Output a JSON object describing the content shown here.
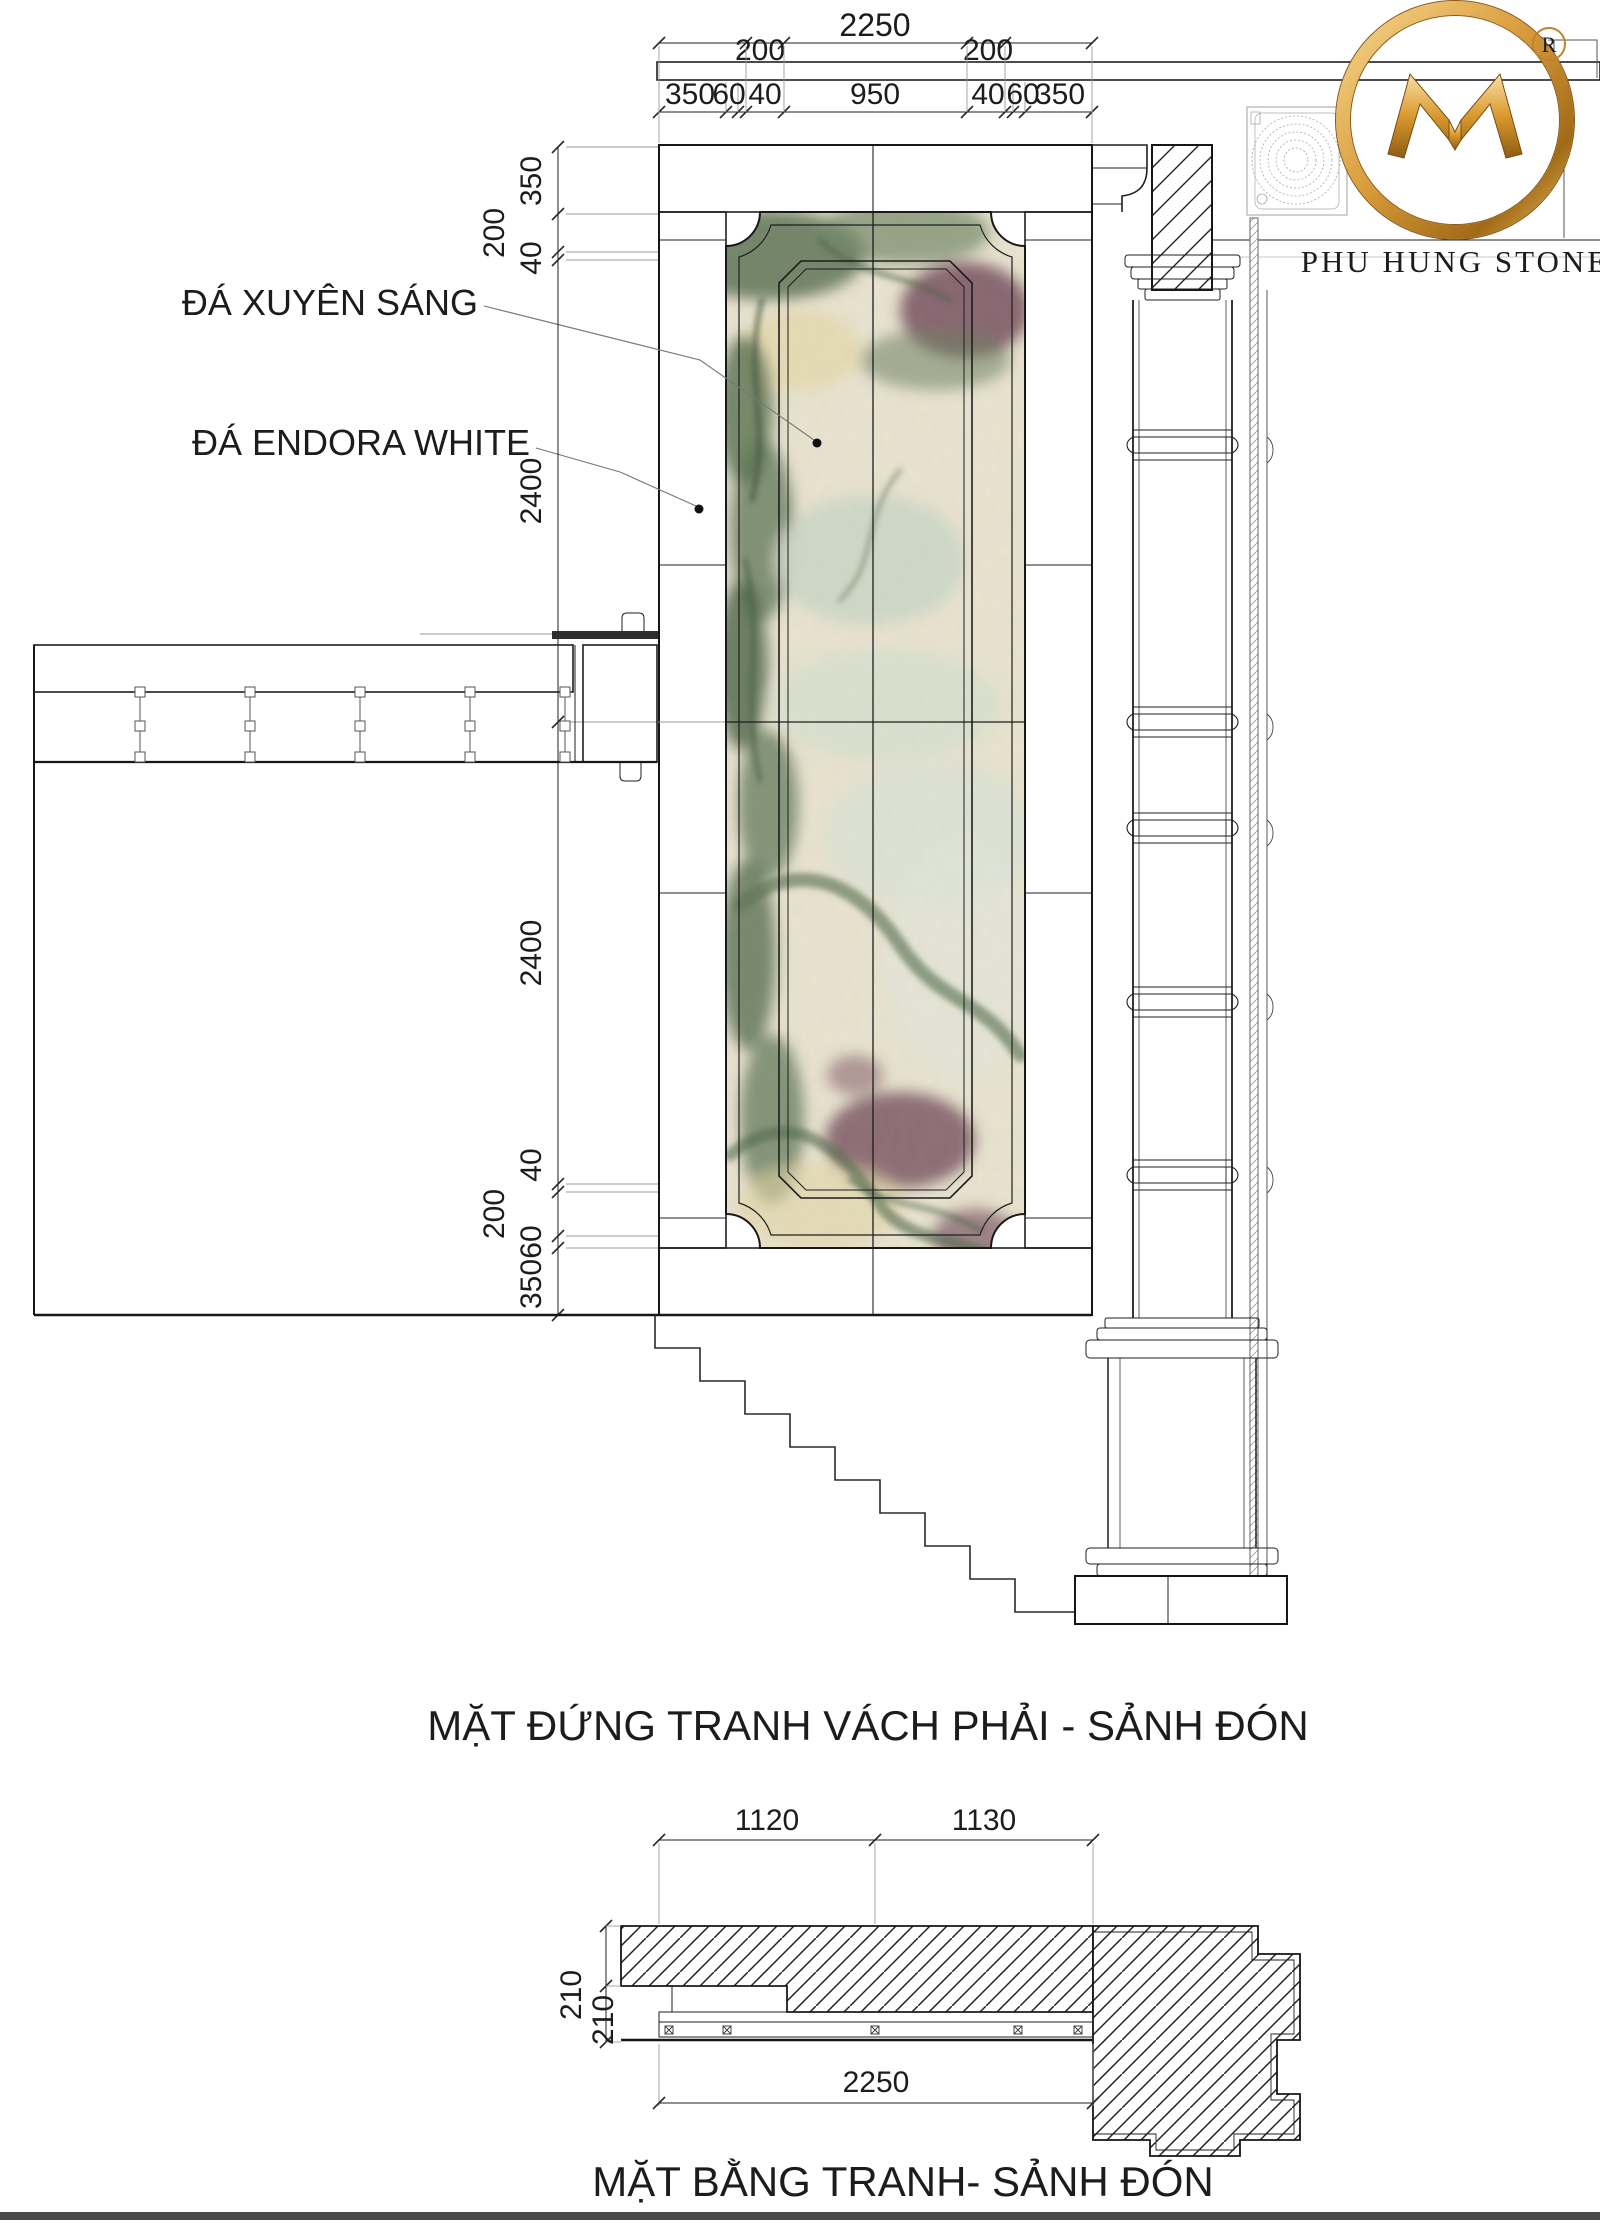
{
  "brand": {
    "name": "PHU HUNG STONE",
    "registered": "®",
    "monogram": "M-monogram"
  },
  "material_labels": {
    "translucent": "ĐÁ XUYÊN SÁNG",
    "endora": "ĐÁ ENDORA WHITE"
  },
  "titles": {
    "elevation": "MẶT ĐỨNG TRANH VÁCH PHẢI - SẢNH ĐÓN",
    "plan": "MẶT BẰNG TRANH- SẢNH ĐÓN"
  },
  "dims": {
    "elev_overall_width": "2250",
    "elev_top_offsets": [
      "200",
      "200"
    ],
    "elev_top_chain": [
      "350",
      "60",
      "40",
      "950",
      "40",
      "60",
      "350"
    ],
    "elev_left_upper": [
      "350",
      "200",
      "40",
      "2400"
    ],
    "elev_left_lower": [
      "2400",
      "40",
      "200",
      "60",
      "350"
    ],
    "plan_top": [
      "1120",
      "1130"
    ],
    "plan_side": [
      "210",
      "210"
    ],
    "plan_bottom": "2250"
  },
  "colors": {
    "gold": "#bf8330",
    "gold_light": "#f3c976",
    "gold_dark": "#8f5c14",
    "line": "#1f1f1f",
    "marble_base": "#e9e3d0",
    "marble_green": "#5e7457",
    "marble_maroon": "#7e5a66"
  }
}
